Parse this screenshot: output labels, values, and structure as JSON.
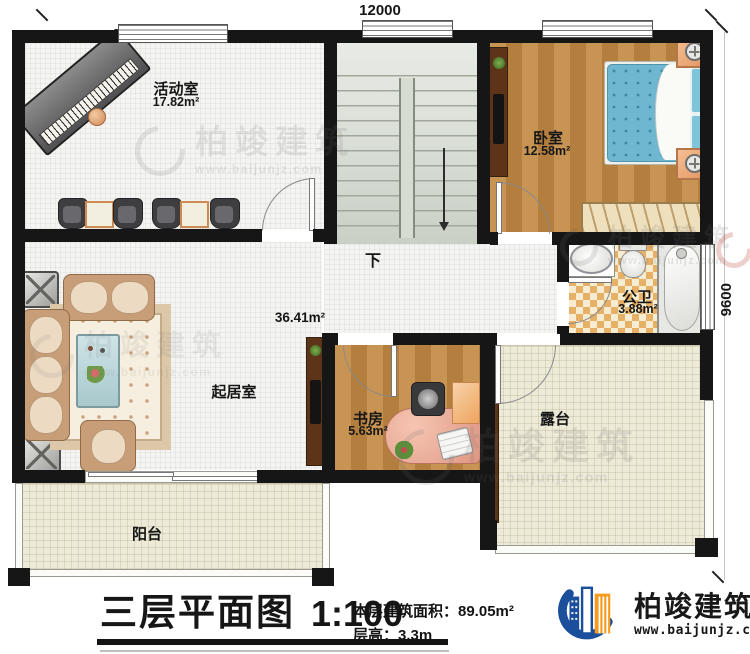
{
  "plan": {
    "dimensions": {
      "width_label": "12000",
      "height_label": "9600"
    },
    "rooms": {
      "activity": {
        "name": "活动室",
        "area": "17.82m²"
      },
      "bedroom": {
        "name": "卧室",
        "area": "12.58m²"
      },
      "bathroom": {
        "name": "公卫",
        "area": "3.88m²"
      },
      "living": {
        "name": "起居室",
        "area": "36.41m²"
      },
      "study": {
        "name": "书房",
        "area": "5.63m²"
      },
      "terrace": {
        "name": "露台"
      },
      "balcony": {
        "name": "阳台"
      }
    },
    "stairs": {
      "down_label": "下"
    }
  },
  "footer": {
    "title": "三层平面图",
    "scale": "1:100",
    "area_line": "本层建筑面积：89.05m²",
    "height_line": "层高：3.3m"
  },
  "brand": {
    "name": "柏竣建筑",
    "url": "www.baijunjz.com"
  },
  "watermark": {
    "name": "柏竣建筑",
    "url": "www.baijunjz.com"
  },
  "colors": {
    "wall": "#161616",
    "brand_blue": "#1b4f9c",
    "brand_orange": "#f59b1e",
    "bed_blue": "#6fb6d1"
  }
}
